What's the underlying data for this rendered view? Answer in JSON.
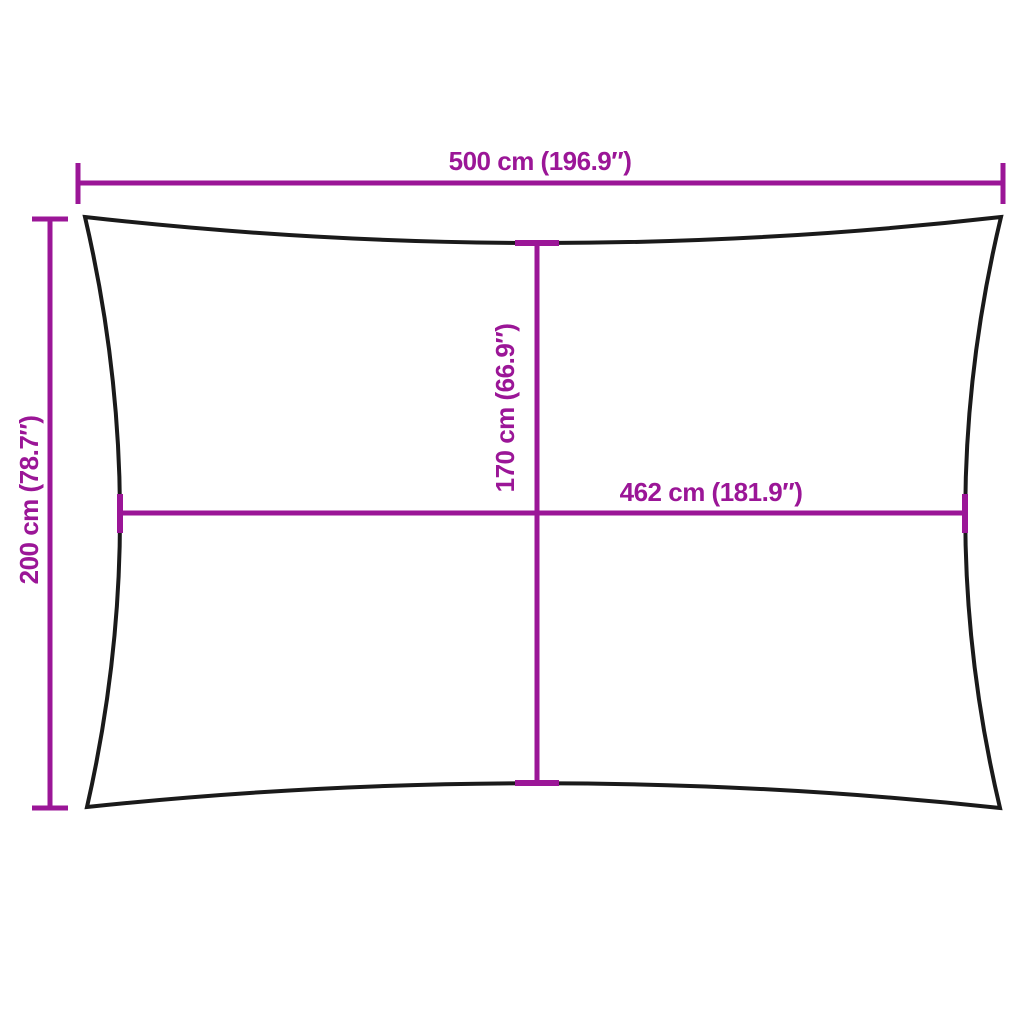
{
  "diagram": {
    "kind": "product-dimension-diagram",
    "dimensions": {
      "top_width": {
        "label": "500 cm (196.9″)",
        "value_cm": 500,
        "value_in": 196.9
      },
      "left_height": {
        "label": "200 cm (78.7″)",
        "value_cm": 200,
        "value_in": 78.7
      },
      "inner_height": {
        "label": "170 cm (66.9″)",
        "value_cm": 170,
        "value_in": 66.9
      },
      "inner_width": {
        "label": "462 cm (181.9″)",
        "value_cm": 462,
        "value_in": 181.9
      }
    },
    "colors": {
      "dimension_accent": "#9B1697",
      "outline": "#1A1A1A",
      "background": "#FFFFFF"
    }
  }
}
